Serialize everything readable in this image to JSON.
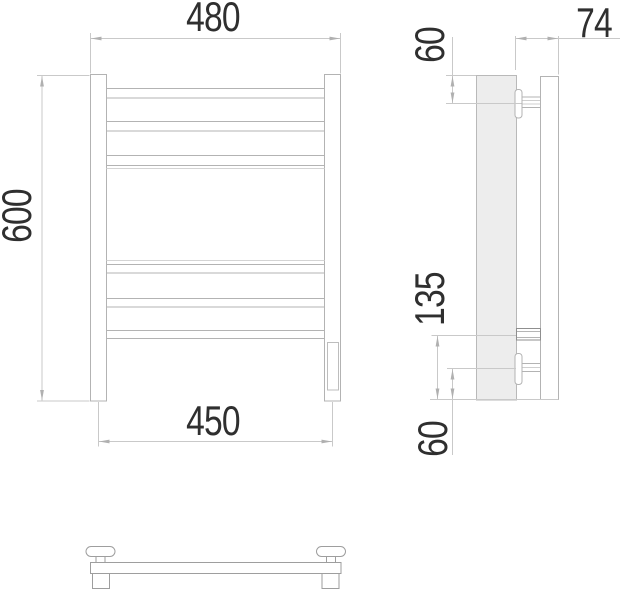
{
  "drawing": {
    "type": "technical-dimension-drawing",
    "subject": "towel-rail-orthographic-views",
    "dimensions": {
      "front": {
        "overall_width": "480",
        "overall_height": "600",
        "rail_center_width": "450"
      },
      "side": {
        "depth": "74",
        "top_bracket_offset": "60",
        "lower_section_height": "135",
        "bottom_offset": "60"
      }
    },
    "colors": {
      "outline": "#b3b3b3",
      "shaded_fill": "#ededed",
      "dimension_line": "#c9c9c9",
      "dark_outline": "#8f8f8f",
      "label_text": "#2f2f2f",
      "background": "#ffffff"
    }
  }
}
